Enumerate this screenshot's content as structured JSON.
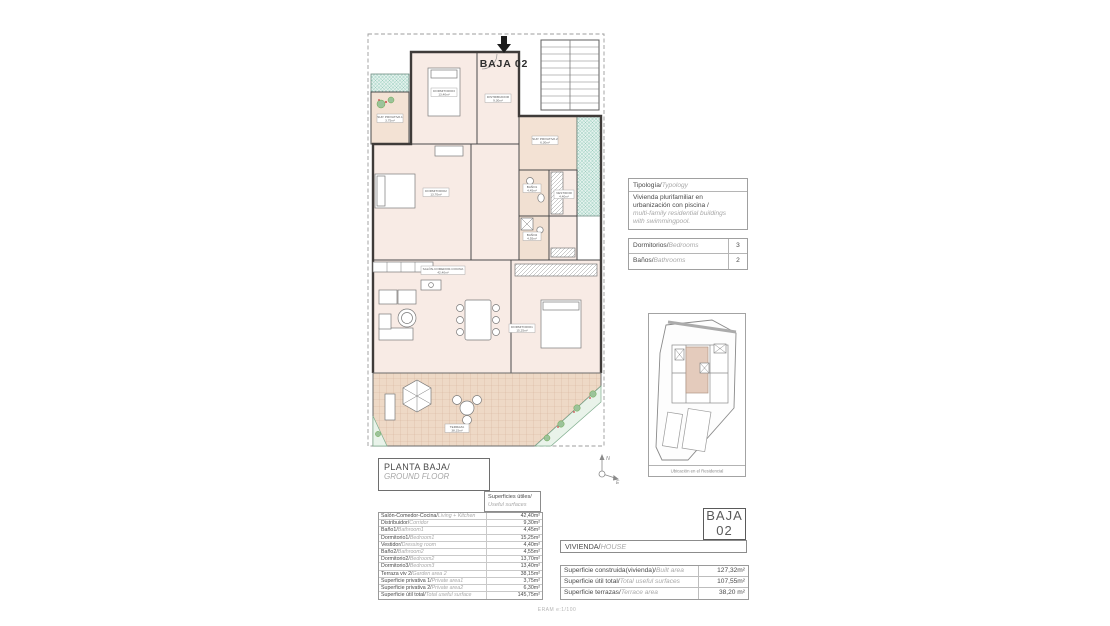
{
  "plan": {
    "unit_label": "BAJA 02",
    "tags": [
      {
        "name": "SUP. PRIVATIVA 1",
        "area": "3,75m²"
      },
      {
        "name": "DORMITORIO3",
        "area": "13,40m²"
      },
      {
        "name": "DISTRIBUIDOR",
        "area": "9,30m²"
      },
      {
        "name": "SUP. PRIVATIVA 2",
        "area": "6,30m²"
      },
      {
        "name": "DORMITORIO2",
        "area": "13,70m²"
      },
      {
        "name": "BAÑO1",
        "area": "4,45m²"
      },
      {
        "name": "VESTIDOR",
        "area": "4,40m²"
      },
      {
        "name": "BAÑO2",
        "area": "4,55m²"
      },
      {
        "name": "SALÓN-COMEDOR-COCINA",
        "area": "42,40m²"
      },
      {
        "name": "DORMITORIO1",
        "area": "15,25m²"
      },
      {
        "name": "TERRAZA",
        "area": "38,15m²"
      }
    ]
  },
  "typology": {
    "header_es": "Tipología/",
    "header_en": "Typology",
    "body_es_1": "Vivienda plurifamiliar en",
    "body_es_2": "urbanización con piscina  /",
    "body_en_1": "multi-family residential buildings",
    "body_en_2": "with swimmingpool.",
    "rows": [
      {
        "label_es": "Dormitorios/",
        "label_en": "Bedrooms",
        "value": "3"
      },
      {
        "label_es": "Baños/",
        "label_en": "Bathrooms",
        "value": "2"
      }
    ]
  },
  "site_map": {
    "caption": "Ubicación en el Residencial"
  },
  "compass": {
    "north": "N",
    "east": "E"
  },
  "title_block": {
    "title_es": "PLANTA BAJA/",
    "title_en": "GROUND FLOOR"
  },
  "surfaces_header": {
    "line1_es": "Superficies útiles/",
    "line1_en": "Useful surfaces"
  },
  "surfaces_table": {
    "rows": [
      {
        "label_es": "Salón-Comedor-Cocina/",
        "label_en": "Living + Kitchen",
        "value": "42,40m²"
      },
      {
        "label_es": "Distribuidor/",
        "label_en": "Corridor",
        "value": "9,30m²"
      },
      {
        "label_es": "Baño1/",
        "label_en": "Bathroom1",
        "value": "4,45m²"
      },
      {
        "label_es": "Dormitorio1/",
        "label_en": "Bedroom1",
        "value": "15,25m²"
      },
      {
        "label_es": "Vestidor/",
        "label_en": "Dressing room",
        "value": "4,40m²"
      },
      {
        "label_es": "Baño2/",
        "label_en": "Bathroom2",
        "value": "4,55m²"
      },
      {
        "label_es": "Dormitorio2/",
        "label_en": "Bedroom2",
        "value": "13,70m²"
      },
      {
        "label_es": "Dormitorio3/",
        "label_en": "Bedroom3",
        "value": "13,40m²"
      },
      {
        "label_es": "Terraza viv 2/",
        "label_en": "Garden area 2",
        "value": "38,15m²"
      },
      {
        "label_es": "Superficie privativa 1/",
        "label_en": "Private area1",
        "value": "3,75m²"
      },
      {
        "label_es": "Superficie privativa 2/",
        "label_en": "Private area2",
        "value": "6,30m²"
      },
      {
        "label_es": "Superficie útil total/",
        "label_en": "Total useful surface",
        "value": "145,75m²"
      }
    ]
  },
  "unit_box": {
    "line1": "BAJA",
    "line2": "02"
  },
  "house_bar": {
    "label_es": "VIVIENDA/",
    "label_en": "HOUSE"
  },
  "summary_table": {
    "rows": [
      {
        "label_es": "Superficie construida(vivienda)/",
        "label_en": "Built area",
        "value": "127,32m²"
      },
      {
        "label_es": "Superficie útil total/",
        "label_en": "Total useful surfaces",
        "value": "107,55m²"
      },
      {
        "label_es": "Superficie terrazas/",
        "label_en": "Terrace area",
        "value": "38,20 m²"
      }
    ]
  },
  "scale_note": "ERAM  e:1/100"
}
